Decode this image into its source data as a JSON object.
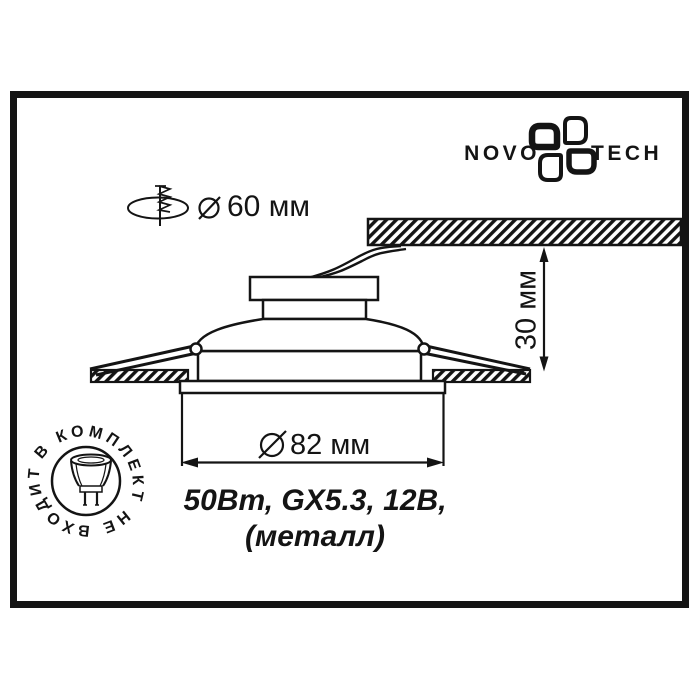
{
  "colors": {
    "ink": "#141414",
    "background": "#ffffff"
  },
  "logo": {
    "brand_left": "NOVO",
    "brand_right": "TECH"
  },
  "cutout_callout": {
    "label": "60 мм",
    "symbol": "⌀"
  },
  "depth_dimension": {
    "label": "30 мм"
  },
  "trim_dimension": {
    "label": "82 мм",
    "symbol": "⌀"
  },
  "specs": {
    "line1": "50Вт, GX5.3, 12В,",
    "line2": "(металл)"
  },
  "stamp": {
    "text": "В КОМПЛЕКТ НЕ ВХОДИТ"
  },
  "icons": {
    "novotech-pinwheel-icon": "four-petal pinwheel logo mark",
    "drill-cutout-icon": "screw through ceiling hole ellipse",
    "diameter-icon": "circle with diagonal slash (⌀)",
    "lamp-mr16-icon": "MR16 halogen lamp with two pins"
  }
}
